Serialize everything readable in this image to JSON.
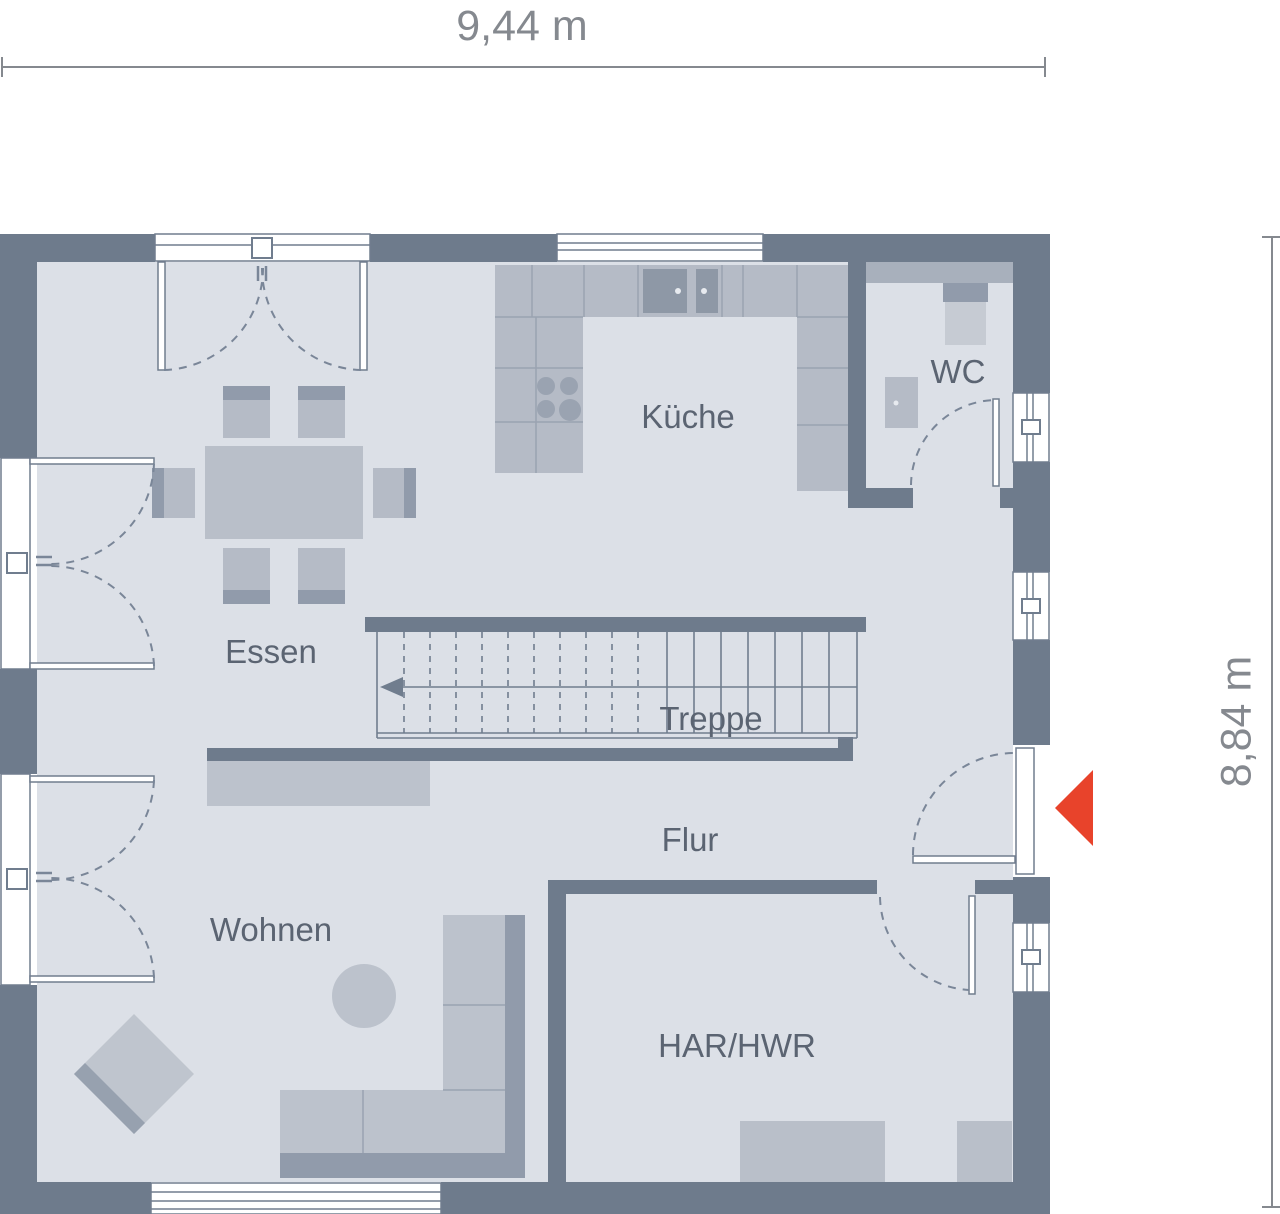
{
  "title": "floor-plan",
  "dimensions": {
    "width_label": "9,44 m",
    "height_label": "8,84 m"
  },
  "rooms": {
    "essen": "Essen",
    "kueche": "Küche",
    "wc": "WC",
    "treppe": "Treppe",
    "flur": "Flur",
    "wohnen": "Wohnen",
    "har": "HAR/HWR"
  },
  "icons": {
    "entrance_marker": "left-pointing-triangle",
    "stairs_direction": "arrow-left"
  },
  "colors": {
    "wall": "#6e7b8c",
    "floor": "#dce0e7",
    "furniture": "#b5bbc6",
    "furniture_dark": "#919bab",
    "furniture_light": "#c6cbd3",
    "line": "#707d8e",
    "label_text": "#5b6472",
    "dimension_text": "#85898f",
    "entrance_accent": "#e8432b",
    "background": "#ffffff"
  }
}
